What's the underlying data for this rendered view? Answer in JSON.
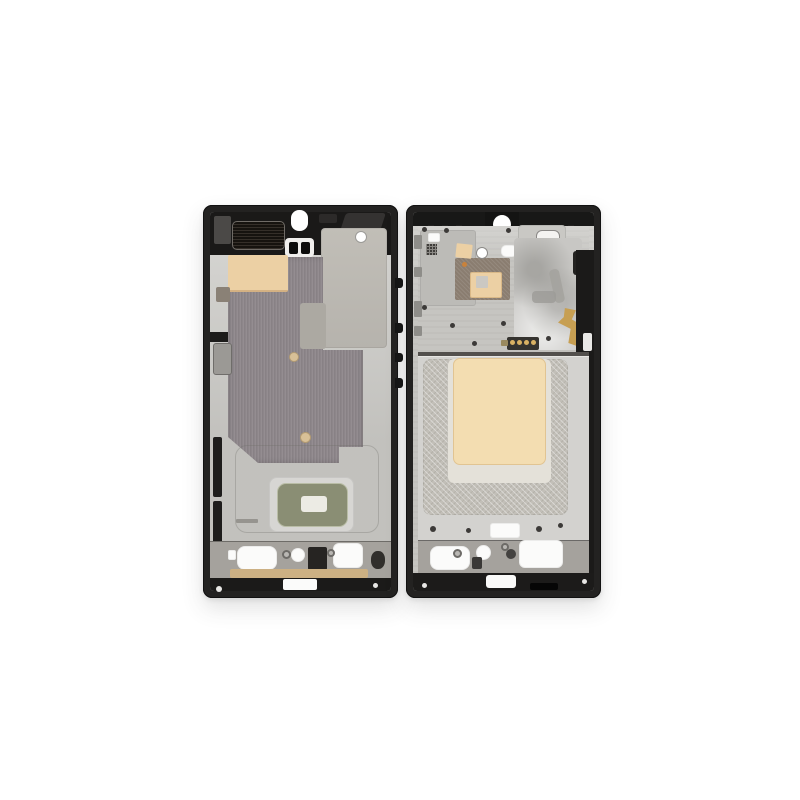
{
  "scene": {
    "type": "product-photo",
    "subject": "smartphone middle frame housing, black, shown from back (left) and front (right)",
    "background": "#ffffff"
  },
  "colors": {
    "bg": "#ffffff",
    "frame": "#232221",
    "topzone": "#1a1918",
    "silver": "#cac9c5",
    "machined": "#c6c5c1",
    "silver_dark": "#a5a29d",
    "silver_plate": "#d7d6d3",
    "sheet": "#b6b3ad",
    "graphite": "#8d868a",
    "beige": "#ecd0a4",
    "beige_big": "#f3ddb1",
    "beige_dot": "#d8c097",
    "ivory": "#e4e1d9",
    "crosshatch": "#c2bfb8",
    "cavity": "#d3d2cf",
    "olive": "#8a8e74",
    "olive_pale": "#ecebe4",
    "gold": "#c79f52",
    "gold_strip": "#ccb083",
    "gold_dot": "#d9b163",
    "mesh": "#16130f",
    "brown": "#8a7d70",
    "gray_block": "#9b9995",
    "contact": "#35332f",
    "divider": "#524f4c",
    "swirl": "#c8c7c4",
    "band_black": "#1b1a19",
    "qr": "#3f3d3a",
    "orange": "#c8823c"
  }
}
